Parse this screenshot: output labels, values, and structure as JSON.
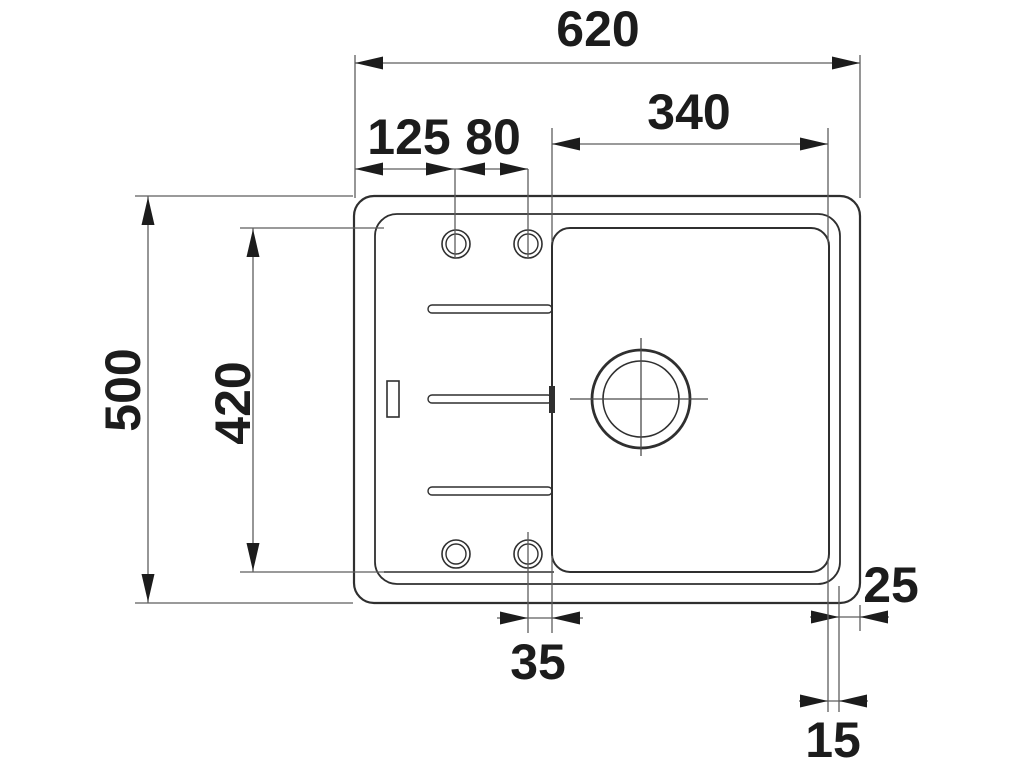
{
  "drawing": {
    "dimensions": {
      "overall_width": "620",
      "bowl_width": "340",
      "tap_hole_left_offset": "125",
      "tap_hole_spacing": "80",
      "overall_depth": "500",
      "bowl_depth": "420",
      "tap_hole_to_bowl_gap": "35",
      "rim_to_edge_right": "25",
      "bowl_to_rim_right": "15"
    }
  }
}
